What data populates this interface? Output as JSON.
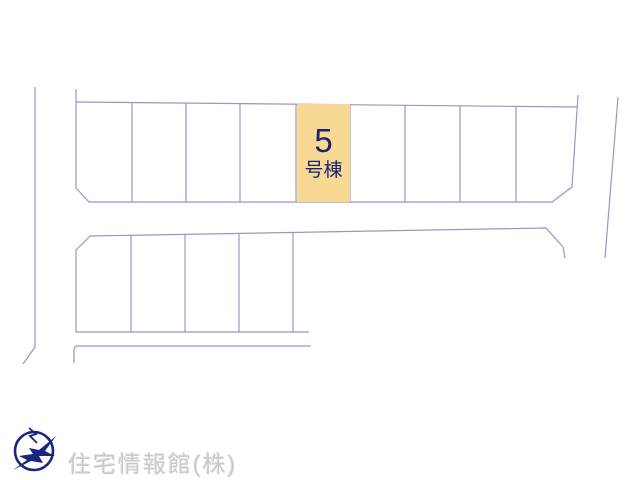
{
  "canvas": {
    "width": 640,
    "height": 480,
    "background": "#ffffff"
  },
  "map": {
    "type": "residential-lot-plan",
    "line_color": "#9598c6",
    "top_row_lot_count": 9,
    "second_row_lot_count": 5,
    "highlighted_lot": {
      "number": "5",
      "suffix": "号棟",
      "fill_color": "#f7d994",
      "text_color": "#1c2270"
    }
  },
  "branding": {
    "company_name": "住宅情報館(株)",
    "logo_icon": "bird-in-circle",
    "logo_color": "#1a2580",
    "watermark_color": "#c9c9c9"
  }
}
